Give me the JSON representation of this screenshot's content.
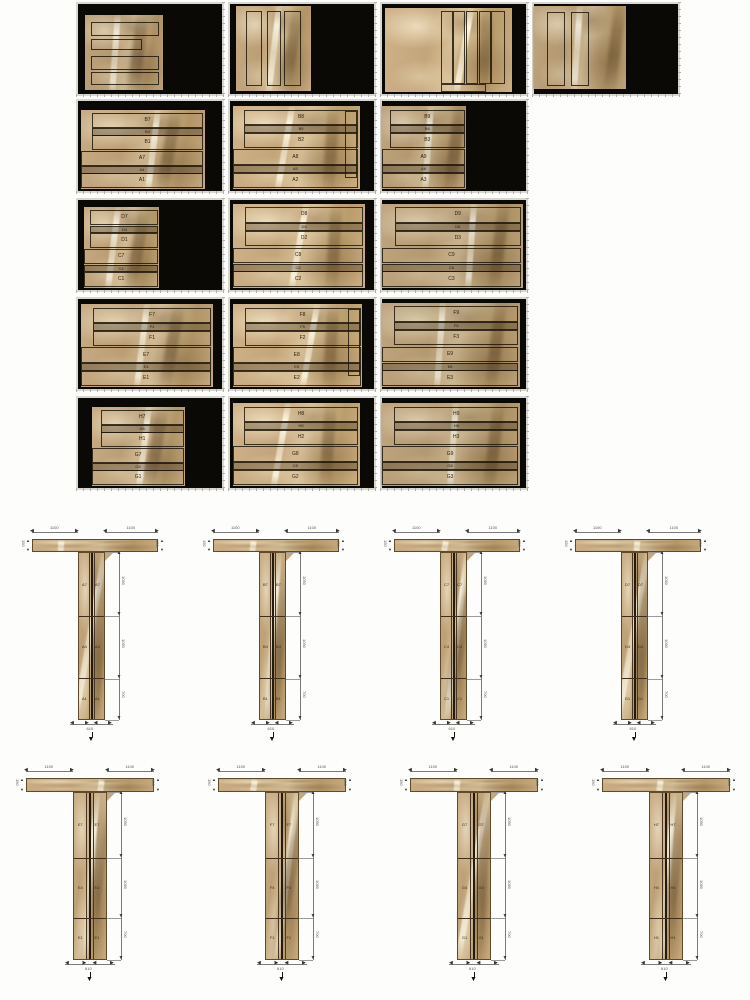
{
  "document": {
    "kind": "stone-slab cutting layout and T-column assembly drawing"
  },
  "colors": {
    "panel_background": "#0b0906",
    "marble_base": "#c9ad85",
    "marble_light": "#e9dcbc",
    "marble_dark": "#8a6b49",
    "cut_line": "#3a2c14",
    "dimension_line": "#777777",
    "gutter": "#d9d7d2"
  },
  "cut_sheets": {
    "row1": [
      {
        "id": "sheet-A",
        "orientation": "horizontal",
        "slab": [
          5,
          12,
          54,
          84
        ],
        "strips": [
          [
            8,
            10,
            84,
            16
          ],
          [
            8,
            32,
            62,
            12
          ],
          [
            8,
            54,
            84,
            16
          ],
          [
            8,
            76,
            84,
            14
          ]
        ]
      },
      {
        "id": "sheet-B",
        "orientation": "vertical",
        "slab": [
          4,
          2,
          52,
          95
        ],
        "strips": [
          [
            14,
            6,
            18,
            86
          ],
          [
            42,
            6,
            16,
            86
          ],
          [
            64,
            6,
            20,
            86
          ]
        ]
      },
      {
        "id": "sheet-C",
        "orientation": "vertical",
        "slab": [
          2,
          4,
          88,
          94
        ],
        "strips": [
          [
            44,
            4,
            8,
            84
          ],
          [
            54,
            4,
            8,
            84
          ],
          [
            64,
            4,
            8,
            84
          ],
          [
            74,
            4,
            8,
            84
          ],
          [
            84,
            4,
            9,
            84
          ],
          [
            44,
            90,
            34,
            7
          ]
        ]
      },
      {
        "id": "sheet-D",
        "orientation": "vertical",
        "slab": [
          0,
          2,
          64,
          92
        ],
        "strips": [
          [
            14,
            8,
            17,
            86
          ],
          [
            40,
            8,
            17,
            86
          ]
        ]
      }
    ],
    "rows": [
      {
        "panels": [
          {
            "id": "sheet-2-1",
            "slab": [
              2,
              10,
              86,
              88
            ],
            "labels": [
              "B7",
              "B4",
              "B1",
              "A7",
              "A4",
              "A1"
            ],
            "side_strip": false
          },
          {
            "id": "sheet-2-2",
            "slab": [
              2,
              6,
              88,
              92
            ],
            "labels": [
              "B8",
              "B5",
              "B2",
              "A8",
              "A5",
              "A2"
            ],
            "side_strip": true
          },
          {
            "id": "sheet-2-3",
            "slab": [
              0,
              6,
              58,
              92
            ],
            "labels": [
              "B9",
              "B6",
              "B3",
              "A9",
              "A6",
              "A3"
            ],
            "side_strip": false
          }
        ]
      },
      {
        "panels": [
          {
            "id": "sheet-3-1",
            "slab": [
              4,
              8,
              52,
              90
            ],
            "labels": [
              "D7",
              "D4",
              "D1",
              "C7",
              "C4",
              "C1"
            ],
            "side_strip": false
          },
          {
            "id": "sheet-3-2",
            "slab": [
              2,
              4,
              92,
              94
            ],
            "labels": [
              "D8",
              "D5",
              "D2",
              "C8",
              "C5",
              "C2"
            ],
            "side_strip": false
          },
          {
            "id": "sheet-3-3",
            "slab": [
              0,
              4,
              98,
              94
            ],
            "labels": [
              "D9",
              "D6",
              "D3",
              "C9",
              "C6",
              "C3"
            ],
            "side_strip": false
          }
        ]
      },
      {
        "panels": [
          {
            "id": "sheet-4-1",
            "slab": [
              2,
              6,
              92,
              92
            ],
            "labels": [
              "F7",
              "F4",
              "F1",
              "E7",
              "E4",
              "E1"
            ],
            "side_strip": false
          },
          {
            "id": "sheet-4-2",
            "slab": [
              2,
              6,
              90,
              92
            ],
            "labels": [
              "F8",
              "F5",
              "F2",
              "E8",
              "E5",
              "E2"
            ],
            "side_strip": true
          },
          {
            "id": "sheet-4-3",
            "slab": [
              0,
              4,
              96,
              94
            ],
            "labels": [
              "F9",
              "F6",
              "F3",
              "E9",
              "E6",
              "E3"
            ],
            "side_strip": false
          }
        ]
      },
      {
        "panels": [
          {
            "id": "sheet-5-1",
            "slab": [
              10,
              10,
              64,
              88
            ],
            "labels": [
              "H7",
              "H4",
              "H1",
              "G7",
              "G4",
              "G1"
            ],
            "side_strip": false
          },
          {
            "id": "sheet-5-2",
            "slab": [
              2,
              6,
              88,
              92
            ],
            "labels": [
              "H8",
              "H5",
              "H2",
              "G8",
              "G5",
              "G2"
            ],
            "side_strip": false
          },
          {
            "id": "sheet-5-3",
            "slab": [
              0,
              6,
              96,
              92
            ],
            "labels": [
              "H9",
              "H6",
              "H3",
              "G9",
              "G6",
              "G3"
            ],
            "side_strip": false
          }
        ]
      }
    ]
  },
  "columns": {
    "rows": [
      {
        "items": [
          {
            "id": "column-1",
            "wing_dims": [
              "1100",
              "1100"
            ],
            "end_dims": [
              "150",
              "150"
            ],
            "segment_dims": [
              "1050",
              "1050",
              "700"
            ],
            "segment_labels": [
              "A7",
              "A4",
              "A1"
            ],
            "bottom_dim": "610"
          },
          {
            "id": "column-2",
            "wing_dims": [
              "1100",
              "1100"
            ],
            "end_dims": [
              "150",
              "150"
            ],
            "segment_dims": [
              "1050",
              "1050",
              "700"
            ],
            "segment_labels": [
              "B7",
              "B4",
              "B1"
            ],
            "bottom_dim": "610"
          },
          {
            "id": "column-3",
            "wing_dims": [
              "1100",
              "1100"
            ],
            "end_dims": [
              "150",
              "150"
            ],
            "segment_dims": [
              "1050",
              "1050",
              "700"
            ],
            "segment_labels": [
              "C7",
              "C4",
              "C1"
            ],
            "bottom_dim": "610"
          },
          {
            "id": "column-4",
            "wing_dims": [
              "1100",
              "1100"
            ],
            "end_dims": [
              "150",
              "150"
            ],
            "segment_dims": [
              "1050",
              "1050",
              "700"
            ],
            "segment_labels": [
              "D7",
              "D4",
              "D1"
            ],
            "bottom_dim": "610"
          }
        ]
      },
      {
        "items": [
          {
            "id": "column-5",
            "wing_dims": [
              "1100",
              "1100"
            ],
            "end_dims": [
              "150",
              "150"
            ],
            "segment_dims": [
              "1050",
              "1050",
              "700"
            ],
            "segment_labels": [
              "E7",
              "E4",
              "E1"
            ],
            "bottom_dim": "610"
          },
          {
            "id": "column-6",
            "wing_dims": [
              "1100",
              "1100"
            ],
            "end_dims": [
              "150",
              "150"
            ],
            "segment_dims": [
              "1050",
              "1050",
              "700"
            ],
            "segment_labels": [
              "F7",
              "F4",
              "F1"
            ],
            "bottom_dim": "610"
          },
          {
            "id": "column-7",
            "wing_dims": [
              "1100",
              "1100"
            ],
            "end_dims": [
              "150",
              "150"
            ],
            "segment_dims": [
              "1050",
              "1050",
              "700"
            ],
            "segment_labels": [
              "G7",
              "G4",
              "G1"
            ],
            "bottom_dim": "610"
          },
          {
            "id": "column-8",
            "wing_dims": [
              "1100",
              "1100"
            ],
            "end_dims": [
              "150",
              "150"
            ],
            "segment_dims": [
              "1050",
              "1050",
              "700"
            ],
            "segment_labels": [
              "H7",
              "H4",
              "H1"
            ],
            "bottom_dim": "610"
          }
        ]
      }
    ]
  }
}
